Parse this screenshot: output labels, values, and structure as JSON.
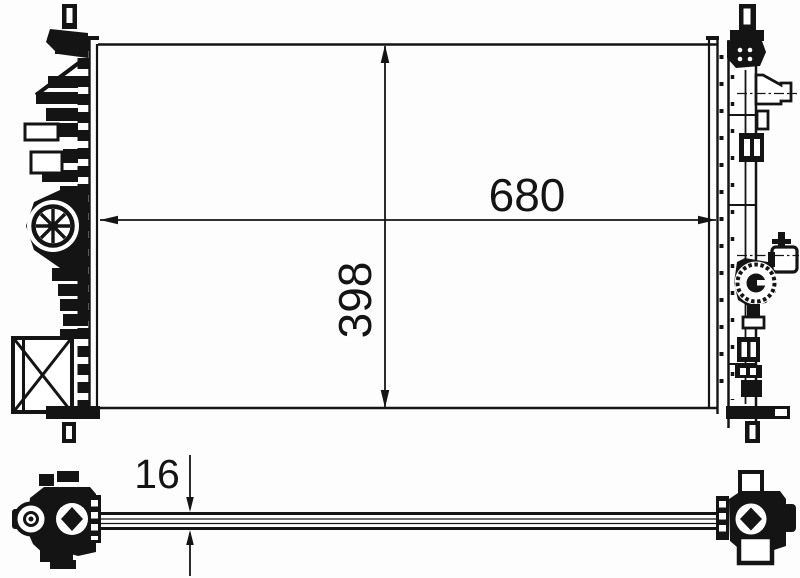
{
  "drawing": {
    "part": "radiator",
    "front_view": {
      "width_label": "680",
      "height_label": "398"
    },
    "side_view": {
      "thickness_label": "16"
    },
    "colors": {
      "line": "#141414",
      "background": "#fdfdfd"
    }
  }
}
